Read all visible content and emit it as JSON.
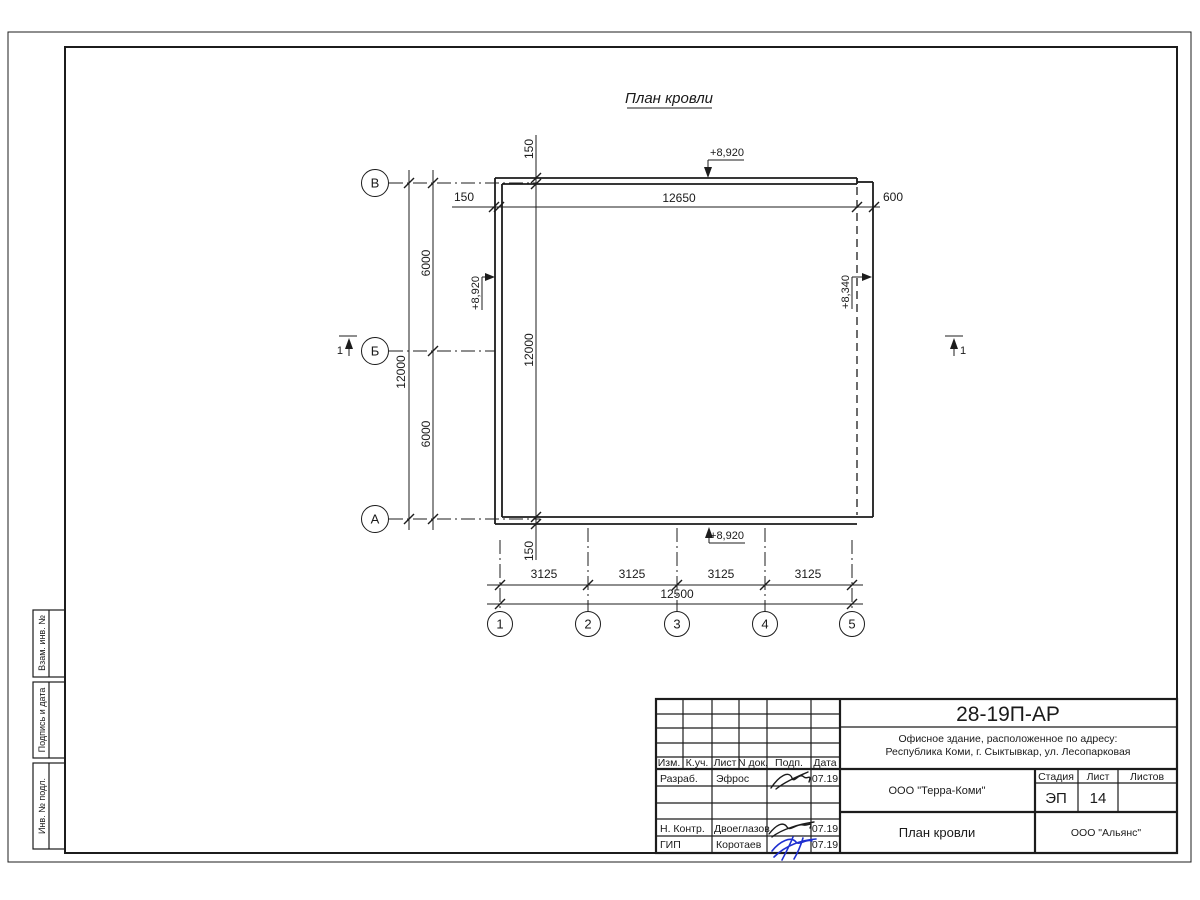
{
  "sheet_title": "План кровли",
  "colors": {
    "line": "#1c1c1c",
    "signature_blue": "#1f2fd0"
  },
  "plan": {
    "axis_rows": [
      "В",
      "Б",
      "А"
    ],
    "axis_cols": [
      "1",
      "2",
      "3",
      "4",
      "5"
    ],
    "dims": {
      "overhang_top": "150",
      "overhang_left": "150",
      "top_span": "12650",
      "right_offset": "600",
      "row_span_top": "6000",
      "row_span_bottom": "6000",
      "left_total": "12000",
      "inner_150_top": "150",
      "inner_height": "12000",
      "inner_150_bottom": "150",
      "col_3125": [
        "3125",
        "3125",
        "3125",
        "3125"
      ],
      "bottom_total": "12500"
    },
    "elevations": {
      "top": "+8,920",
      "left": "+8,920",
      "right": "+8,340",
      "bottom": "+8,920"
    },
    "section_left": "1",
    "section_right": "1"
  },
  "margin_boxes": [
    "Взам. инв. №",
    "Подпись и дата",
    "Инв. № подл."
  ],
  "title_block": {
    "doc_number": "28-19П-АР",
    "object_line1": "Офисное здание, расположенное по адресу:",
    "object_line2": "Республика Коми, г. Сыктывкар, ул. Лесопарковая",
    "header_cols": [
      "Изм.",
      "К.уч.",
      "Лист",
      "N док.",
      "Подп.",
      "Дата"
    ],
    "rows": [
      {
        "role": "Разраб.",
        "name": "Эфрос",
        "date": "07.19"
      },
      {
        "role": "Н. Контр.",
        "name": "Двоеглазов",
        "date": "07.19"
      },
      {
        "role": "ГИП",
        "name": "Коротаев",
        "date": "07.19"
      }
    ],
    "company": "ООО \"Терра-Коми\"",
    "stage_label": "Стадия",
    "sheet_label": "Лист",
    "sheets_label": "Листов",
    "stage_value": "ЭП",
    "sheet_value": "14",
    "sheets_value": "",
    "drawing_title": "План кровли",
    "contractor": "ООО \"Альянс\""
  }
}
